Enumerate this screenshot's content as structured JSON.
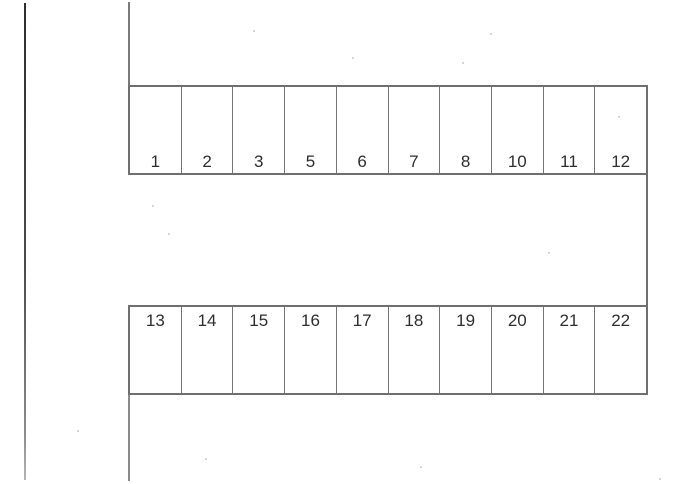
{
  "diagram_type": "parking-lot-layout",
  "rows": [
    {
      "name": "top-row",
      "label_position": "bottom",
      "labels": [
        "1",
        "2",
        "3",
        "5",
        "6",
        "7",
        "8",
        "10",
        "11",
        "12"
      ]
    },
    {
      "name": "bottom-row",
      "label_position": "top",
      "labels": [
        "13",
        "14",
        "15",
        "16",
        "17",
        "18",
        "19",
        "20",
        "21",
        "22"
      ]
    }
  ],
  "colors": {
    "background": "#ffffff",
    "stall_line": "#6f6f6f",
    "page_edge_line": "#3c3c3c",
    "number_text": "#2e2e2e"
  }
}
